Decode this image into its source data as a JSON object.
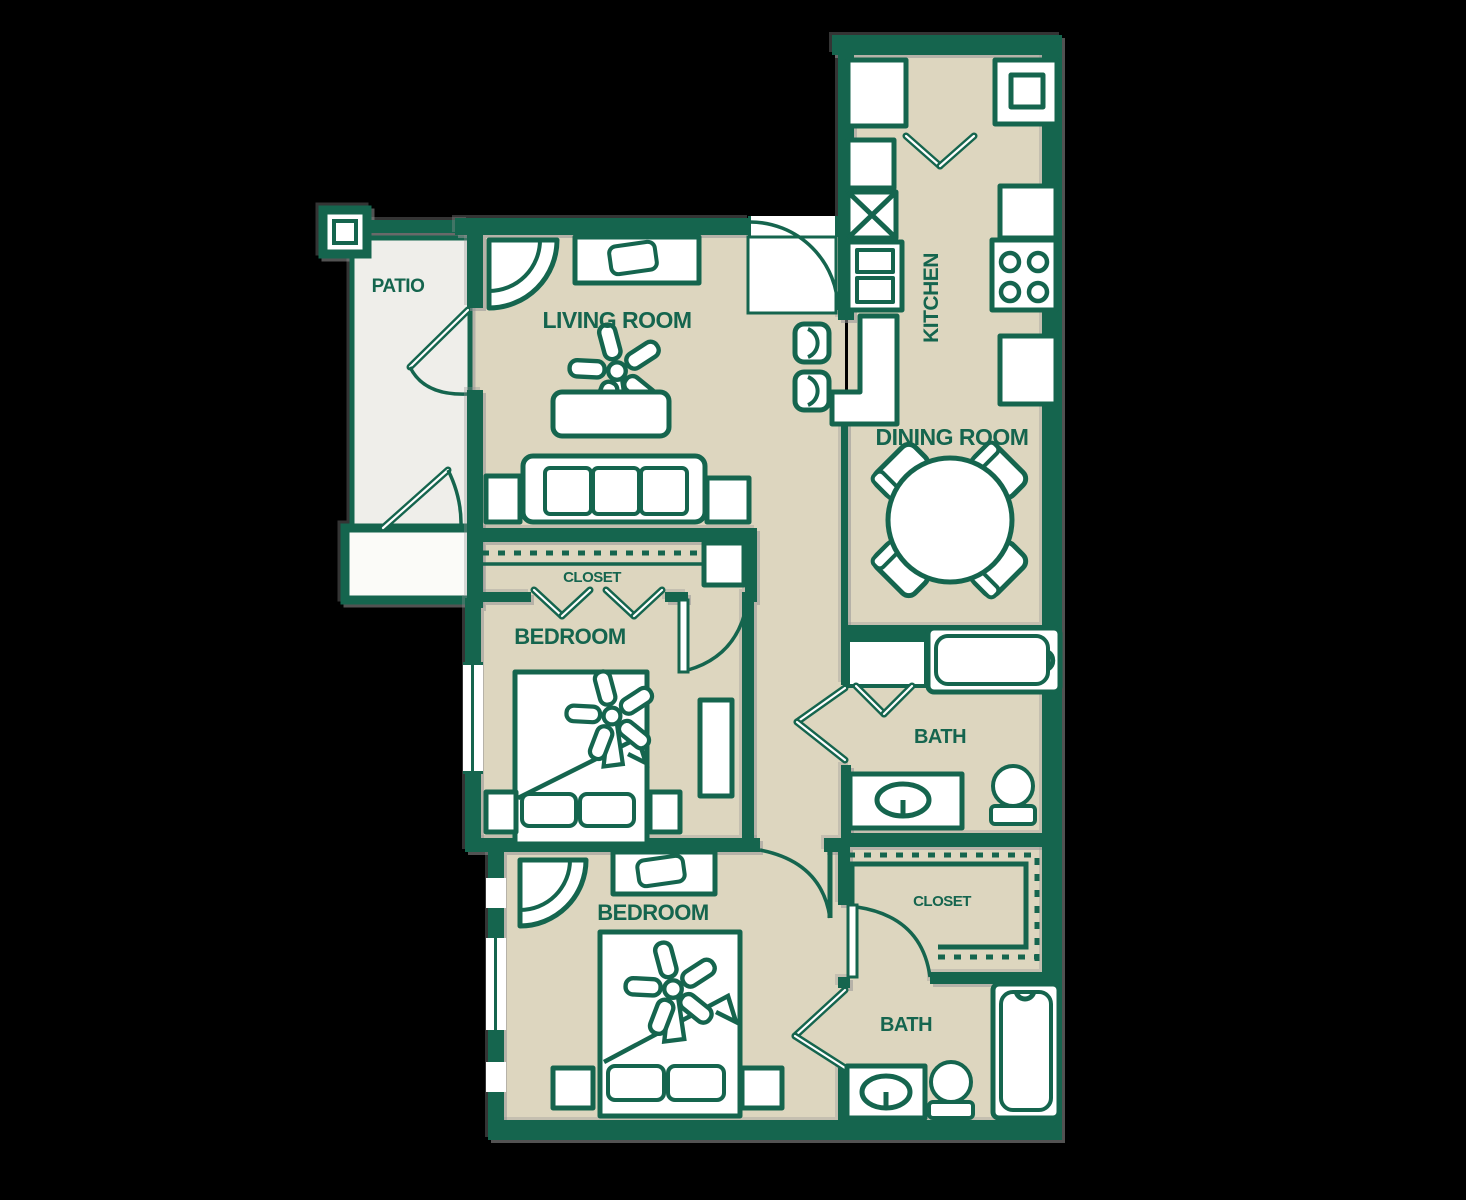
{
  "plan": {
    "rooms": {
      "patio": {
        "label": "PATIO"
      },
      "living_room": {
        "label": "LIVING ROOM"
      },
      "kitchen": {
        "label": "KITCHEN"
      },
      "dining_room": {
        "label": "DINING ROOM"
      },
      "bedroom_1": {
        "label": "BEDROOM"
      },
      "closet_1": {
        "label": "CLOSET"
      },
      "bath_1": {
        "label": "BATH"
      },
      "bedroom_2": {
        "label": "BEDROOM"
      },
      "closet_2": {
        "label": "CLOSET"
      },
      "bath_2": {
        "label": "BATH"
      }
    },
    "colors": {
      "wall_green": "#15654E",
      "floor_tan": "#DDD6BF",
      "patio_gray": "#EFEEEA",
      "background": "#000000",
      "fixture_white": "#FFFFFF"
    }
  }
}
